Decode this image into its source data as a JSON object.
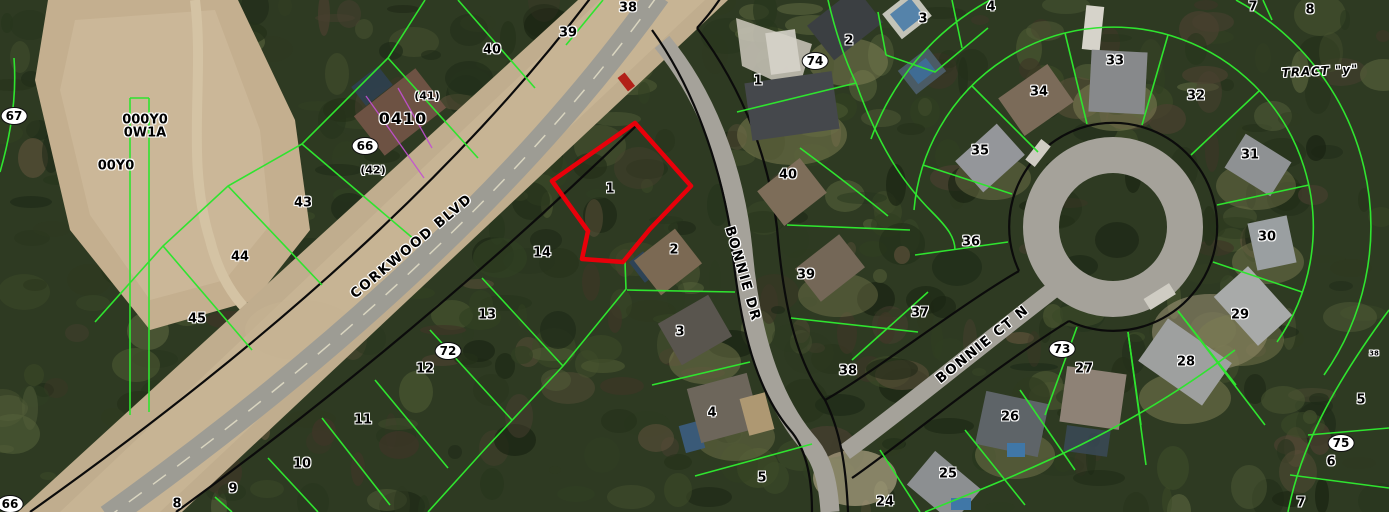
{
  "map": {
    "description": "aerial-parcel-map",
    "highlight_color": "#e8000a",
    "parcel_line_color": "#2fe42f",
    "row_line_color": "#0b0b0b",
    "selected_parcel": {
      "label": "1"
    },
    "road_labels": [
      {
        "text": "CORKWOOD BLVD",
        "x": 412,
        "y": 247,
        "rot": -40
      },
      {
        "text": "BONNIE DR",
        "x": 742,
        "y": 274,
        "rot": 74
      },
      {
        "text": "BONNIE CT N",
        "x": 983,
        "y": 345,
        "rot": -39
      }
    ],
    "parcel_labels": [
      {
        "text": "38",
        "x": 628,
        "y": 8,
        "kind": "p"
      },
      {
        "text": "39",
        "x": 568,
        "y": 33,
        "kind": "p"
      },
      {
        "text": "40",
        "x": 492,
        "y": 50,
        "kind": "p"
      },
      {
        "text": "(41)",
        "x": 427,
        "y": 96,
        "kind": "pr"
      },
      {
        "text": "0410",
        "x": 403,
        "y": 119,
        "kind": "b"
      },
      {
        "text": "66",
        "x": 365,
        "y": 146,
        "kind": "c"
      },
      {
        "text": "(42)",
        "x": 373,
        "y": 170,
        "kind": "pr"
      },
      {
        "text": "43",
        "x": 303,
        "y": 203,
        "kind": "p"
      },
      {
        "text": "44",
        "x": 240,
        "y": 257,
        "kind": "p"
      },
      {
        "text": "45",
        "x": 197,
        "y": 319,
        "kind": "p"
      },
      {
        "text": "67",
        "x": 14,
        "y": 116,
        "kind": "c"
      },
      {
        "text": "000Y0",
        "x": 145,
        "y": 120,
        "kind": "p"
      },
      {
        "text": "0W1A",
        "x": 145,
        "y": 133,
        "kind": "p"
      },
      {
        "text": "00Y0",
        "x": 116,
        "y": 166,
        "kind": "p"
      },
      {
        "text": "66",
        "x": 10,
        "y": 504,
        "kind": "c"
      },
      {
        "text": "8",
        "x": 177,
        "y": 504,
        "kind": "p"
      },
      {
        "text": "9",
        "x": 233,
        "y": 489,
        "kind": "p"
      },
      {
        "text": "10",
        "x": 302,
        "y": 464,
        "kind": "p"
      },
      {
        "text": "11",
        "x": 363,
        "y": 420,
        "kind": "p"
      },
      {
        "text": "12",
        "x": 425,
        "y": 369,
        "kind": "p"
      },
      {
        "text": "72",
        "x": 448,
        "y": 351,
        "kind": "c"
      },
      {
        "text": "13",
        "x": 487,
        "y": 315,
        "kind": "p"
      },
      {
        "text": "14",
        "x": 542,
        "y": 253,
        "kind": "p"
      },
      {
        "text": "1",
        "x": 610,
        "y": 189,
        "kind": "p"
      },
      {
        "text": "2",
        "x": 674,
        "y": 250,
        "kind": "p"
      },
      {
        "text": "3",
        "x": 680,
        "y": 332,
        "kind": "p"
      },
      {
        "text": "4",
        "x": 712,
        "y": 413,
        "kind": "p"
      },
      {
        "text": "5",
        "x": 762,
        "y": 478,
        "kind": "p"
      },
      {
        "text": "1",
        "x": 758,
        "y": 81,
        "kind": "p"
      },
      {
        "text": "74",
        "x": 815,
        "y": 61,
        "kind": "c"
      },
      {
        "text": "2",
        "x": 849,
        "y": 41,
        "kind": "p"
      },
      {
        "text": "3",
        "x": 923,
        "y": 19,
        "kind": "p"
      },
      {
        "text": "4",
        "x": 991,
        "y": 7,
        "kind": "p"
      },
      {
        "text": "40",
        "x": 788,
        "y": 175,
        "kind": "p"
      },
      {
        "text": "39",
        "x": 806,
        "y": 275,
        "kind": "p"
      },
      {
        "text": "38",
        "x": 848,
        "y": 371,
        "kind": "p"
      },
      {
        "text": "37",
        "x": 920,
        "y": 313,
        "kind": "p"
      },
      {
        "text": "36",
        "x": 971,
        "y": 242,
        "kind": "p"
      },
      {
        "text": "35",
        "x": 980,
        "y": 151,
        "kind": "p"
      },
      {
        "text": "34",
        "x": 1039,
        "y": 92,
        "kind": "p"
      },
      {
        "text": "33",
        "x": 1115,
        "y": 61,
        "kind": "p"
      },
      {
        "text": "32",
        "x": 1196,
        "y": 96,
        "kind": "p"
      },
      {
        "text": "31",
        "x": 1250,
        "y": 155,
        "kind": "p"
      },
      {
        "text": "30",
        "x": 1267,
        "y": 237,
        "kind": "p"
      },
      {
        "text": "29",
        "x": 1240,
        "y": 315,
        "kind": "p"
      },
      {
        "text": "28",
        "x": 1186,
        "y": 362,
        "kind": "p"
      },
      {
        "text": "73",
        "x": 1062,
        "y": 349,
        "kind": "c"
      },
      {
        "text": "27",
        "x": 1084,
        "y": 369,
        "kind": "p"
      },
      {
        "text": "26",
        "x": 1010,
        "y": 417,
        "kind": "p"
      },
      {
        "text": "25",
        "x": 948,
        "y": 474,
        "kind": "p"
      },
      {
        "text": "24",
        "x": 885,
        "y": 502,
        "kind": "p"
      },
      {
        "text": "7",
        "x": 1253,
        "y": 7,
        "kind": "p"
      },
      {
        "text": "8",
        "x": 1310,
        "y": 10,
        "kind": "p"
      },
      {
        "text": "TRACT \"y\"",
        "x": 1320,
        "y": 71,
        "kind": "tract"
      },
      {
        "text": "5",
        "x": 1361,
        "y": 400,
        "kind": "p"
      },
      {
        "text": "75",
        "x": 1341,
        "y": 443,
        "kind": "c"
      },
      {
        "text": "6",
        "x": 1331,
        "y": 462,
        "kind": "p"
      },
      {
        "text": "7",
        "x": 1301,
        "y": 503,
        "kind": "p"
      },
      {
        "text": "38",
        "x": 1374,
        "y": 354,
        "kind": "tiny"
      }
    ]
  }
}
